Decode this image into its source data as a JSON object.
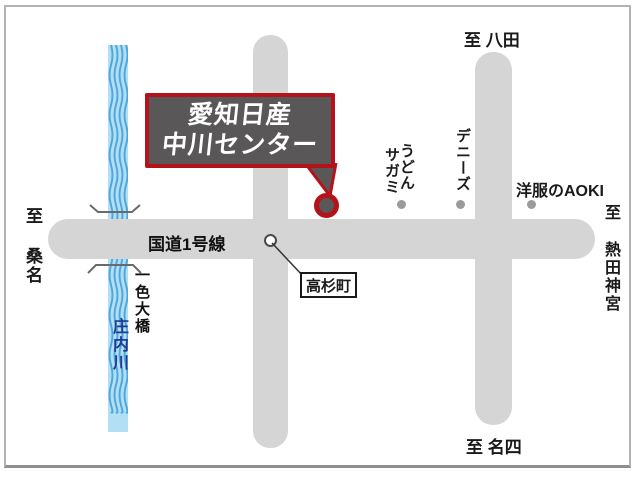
{
  "destination": {
    "line1": "愛知日産",
    "line2": "中川センター"
  },
  "roads": {
    "route1_label": "国道1号線"
  },
  "directions": {
    "top": "至 八田",
    "left": "至 桑名",
    "right": "至 熱田神宮",
    "bottom": "至 名四"
  },
  "river": {
    "name": "庄内川"
  },
  "bridge": {
    "name": "一色大橋"
  },
  "intersection": {
    "name": "高杉町"
  },
  "landmarks": {
    "udon_sagami": {
      "line1": "うどん",
      "line2": "サガミ"
    },
    "dennys": "デニーズ",
    "aoki": "洋服のAOKI"
  },
  "colors": {
    "accent_red": "#b5121b",
    "box_gray": "#595757",
    "road_gray": "#d5d5d5",
    "river_fill_blue": "#b3dff5",
    "river_wave_blue": "#4fa8dd",
    "river_text_navy": "#223a8f",
    "landmark_dot_gray": "#9b9b9b"
  }
}
